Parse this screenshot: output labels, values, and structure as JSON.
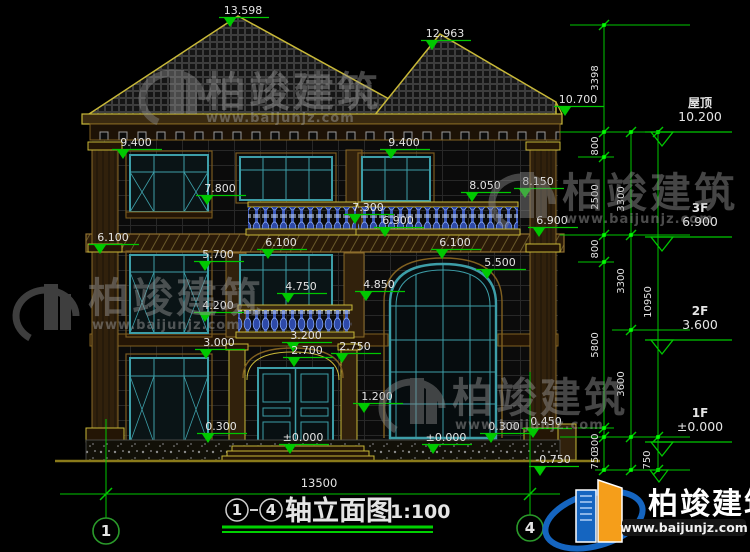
{
  "page": {
    "background": "#000000"
  },
  "drawing": {
    "title": {
      "axis_from": "1",
      "axis_to": "4",
      "name": "轴立面图",
      "scale": "1:100"
    },
    "axis_bubbles": [
      {
        "label": "1"
      },
      {
        "label": "4"
      }
    ],
    "bottom_width": "13500",
    "elevation_annotations": [
      {
        "text": "13.598",
        "x": 243,
        "y": 14
      },
      {
        "text": "12.963",
        "x": 445,
        "y": 37
      },
      {
        "text": "10.700",
        "x": 578,
        "y": 103
      },
      {
        "text": "9.400",
        "x": 136,
        "y": 146
      },
      {
        "text": "9.400",
        "x": 404,
        "y": 146
      },
      {
        "text": "7.800",
        "x": 220,
        "y": 192
      },
      {
        "text": "8.050",
        "x": 485,
        "y": 189
      },
      {
        "text": "8.150",
        "x": 538,
        "y": 185
      },
      {
        "text": "7.300",
        "x": 368,
        "y": 211
      },
      {
        "text": "6.900",
        "x": 398,
        "y": 224
      },
      {
        "text": "6.900",
        "x": 552,
        "y": 224
      },
      {
        "text": "6.100",
        "x": 113,
        "y": 241
      },
      {
        "text": "6.100",
        "x": 281,
        "y": 246
      },
      {
        "text": "6.100",
        "x": 455,
        "y": 246
      },
      {
        "text": "5.700",
        "x": 218,
        "y": 258
      },
      {
        "text": "5.500",
        "x": 500,
        "y": 266
      },
      {
        "text": "4.750",
        "x": 301,
        "y": 290
      },
      {
        "text": "4.850",
        "x": 379,
        "y": 288
      },
      {
        "text": "4.200",
        "x": 218,
        "y": 309
      },
      {
        "text": "3.000",
        "x": 219,
        "y": 346
      },
      {
        "text": "3.200",
        "x": 306,
        "y": 339
      },
      {
        "text": "2.700",
        "x": 307,
        "y": 354
      },
      {
        "text": "2.750",
        "x": 355,
        "y": 350
      },
      {
        "text": "1.200",
        "x": 377,
        "y": 400
      },
      {
        "text": "0.300",
        "x": 221,
        "y": 430
      },
      {
        "text": "±0.000",
        "x": 303,
        "y": 441
      },
      {
        "text": "±0.000",
        "x": 446,
        "y": 441
      },
      {
        "text": "0.300",
        "x": 504,
        "y": 430
      },
      {
        "text": "0.450",
        "x": 546,
        "y": 425
      },
      {
        "text": "-0.750",
        "x": 553,
        "y": 463
      }
    ],
    "right_dimension_labels": [
      {
        "text": "3398",
        "x": 598,
        "y": 78
      },
      {
        "text": "800",
        "x": 598,
        "y": 146
      },
      {
        "text": "2500",
        "x": 598,
        "y": 197
      },
      {
        "text": "800",
        "x": 598,
        "y": 249
      },
      {
        "text": "5800",
        "x": 598,
        "y": 345
      },
      {
        "text": "300",
        "x": 598,
        "y": 443
      },
      {
        "text": "750",
        "x": 598,
        "y": 460
      },
      {
        "text": "3300",
        "x": 624,
        "y": 199
      },
      {
        "text": "3300",
        "x": 624,
        "y": 281
      },
      {
        "text": "3600",
        "x": 624,
        "y": 384
      },
      {
        "text": "750",
        "x": 650,
        "y": 460
      },
      {
        "text": "10950",
        "x": 651,
        "y": 302
      }
    ],
    "dimension_chains": [
      {
        "x": 604,
        "ticks": [
          25,
          132,
          157,
          235,
          262,
          428,
          437,
          470
        ]
      },
      {
        "x": 631,
        "ticks": [
          132,
          235,
          330,
          437,
          470
        ]
      },
      {
        "x": 658,
        "ticks": [
          132,
          437,
          470
        ]
      }
    ],
    "floor_markers": [
      {
        "label": "屋顶",
        "elevation": "10.200",
        "y": 132
      },
      {
        "label": "3F",
        "elevation": "6.900",
        "y": 237
      },
      {
        "label": "2F",
        "elevation": "3.600",
        "y": 340
      },
      {
        "label": "1F",
        "elevation": "±0.000",
        "y": 442
      }
    ],
    "colors": {
      "dimension_green": "#00c800",
      "cad_yellow": "#c8b838",
      "window_teal": "#3d9ea8",
      "baluster_blue": "#4a66cc",
      "text_white": "#e4e4e4"
    }
  },
  "watermark": {
    "brand": "柏竣建筑",
    "url": "www.baijunjz.com",
    "logo_blue": "#1565c0",
    "logo_orange": "#f59e1a"
  }
}
